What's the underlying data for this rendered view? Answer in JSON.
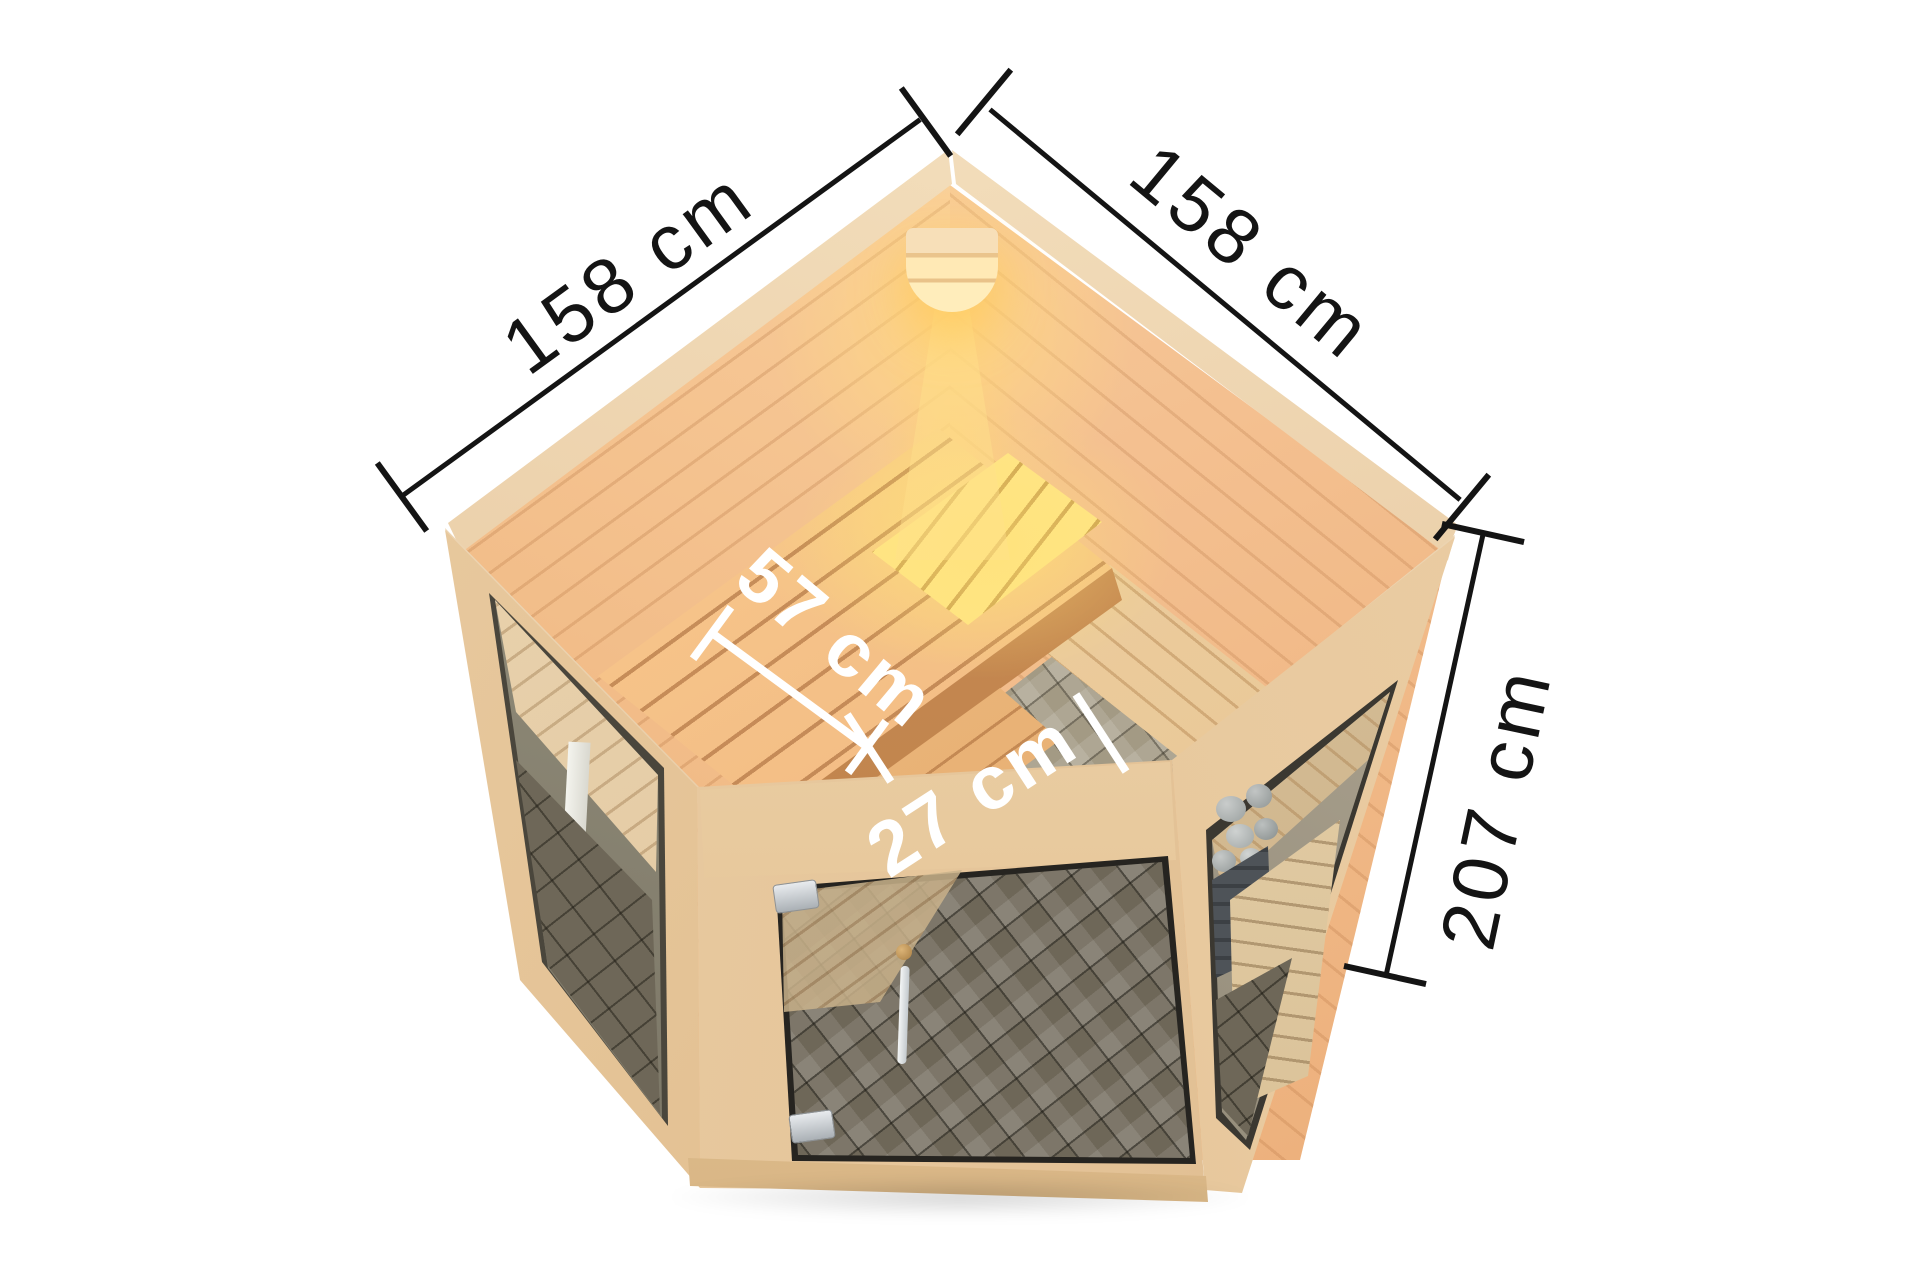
{
  "product_view": {
    "dimension_labels": {
      "width_left": "158 cm",
      "width_right": "158 cm",
      "height": "207 cm",
      "bench_depth": "57 cm",
      "step_depth": "27 cm"
    },
    "colors": {
      "background": "#ffffff",
      "dimension_line": "#141414",
      "dimension_line_light": "#ffffff",
      "wall_light": "#ffe3b8",
      "wall_mid": "#f6c693",
      "wall_deep": "#e9a973",
      "rim_light": "#f7e6c6",
      "rim_shade": "#e3c096",
      "frame_wood": "#eccfa7",
      "frame_shade": "#d9b486",
      "bench_wood": "#f3bd85",
      "bench_shadow": "#cf8f55",
      "bench_glow": "#ffe584",
      "lamp_glow": "#ffd77e",
      "floor_tile": "#a39a84",
      "floor_tile_dark": "#6e6758",
      "glass_dark": "#262420",
      "heater_metal": "#4e5358",
      "heater_stone": "#b7bbba",
      "hardware": "#ccd1d4"
    }
  }
}
